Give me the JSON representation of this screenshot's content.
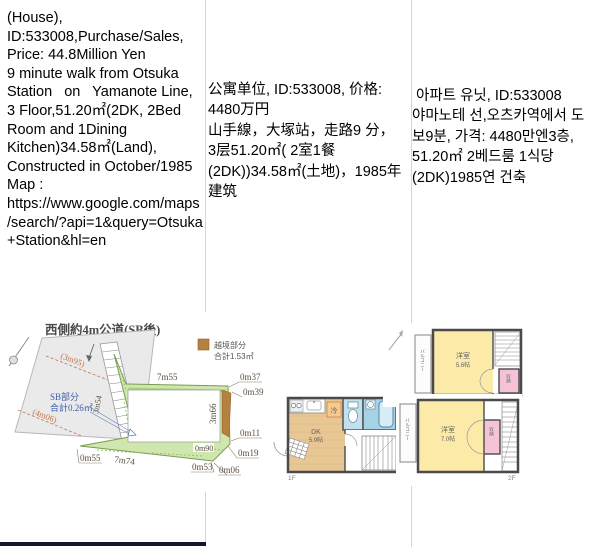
{
  "cells": {
    "en": {
      "text": "(House),\nID:533008,Purchase/Sales,\nPrice: 44.8Million Yen\n9 minute walk from Otsuka\nStation   on   Yamanote Line,\n3 Floor,51.20㎡(2DK, 2Bed\nRoom and 1Dining\nKitchen)34.58㎡(Land),\nConstructed in October/1985\nMap :\nhttps://www.google.com/maps\n/search/?api=1&query=Otsuka\n+Station&hl=en"
    },
    "zh": {
      "text": "公寓单位, ID:533008, 价格:\n4480万円\n山手線，大塚站，走路9 分，\n3层51.20㎡( 2室1餐\n(2DK))34.58㎡(土地)，1985年\n建筑"
    },
    "ko": {
      "text": " 아파트 유닛, ID:533008\n야마노테 선,오츠카역에서 도\n보9분, 가격: 4480만엔3층,\n51.20㎡ 2베드룸 1식당\n(2DK)1985연 건축"
    }
  },
  "landplot": {
    "title": "西側約4m公道(SB後)",
    "legend_label": "越境部分",
    "legend_total": "合計1.53㎡",
    "legend_color": "#b5813f",
    "sb_label": "SB部分",
    "sb_total": "合計0.26㎡",
    "m_3m95": "(3m95)",
    "m_4m06": "(4m06)",
    "m_7m55": "7m55",
    "m_0m37": "0m37",
    "m_0m39": "0m39",
    "m_3m66": "3m66",
    "m_3m54": "3m54",
    "m_0m11": "0m11",
    "m_0m90": "0m90",
    "m_0m19": "0m19",
    "m_0m53": "0m53",
    "m_0m06": "0m06",
    "m_0m55": "0m55",
    "m_7m74": "7m74"
  },
  "floor1": {
    "label": "1F",
    "room": "DK",
    "size": "5.9帖",
    "fridge": "冷"
  },
  "floor2": {
    "label": "2F",
    "room": "洋室",
    "size": "7.0帖",
    "closet": "収納",
    "balcony": "バルコニー"
  },
  "floor3": {
    "label": "3F",
    "room": "洋室",
    "size": "5.6帖",
    "closet": "収納",
    "balcony": "バルコニー"
  }
}
